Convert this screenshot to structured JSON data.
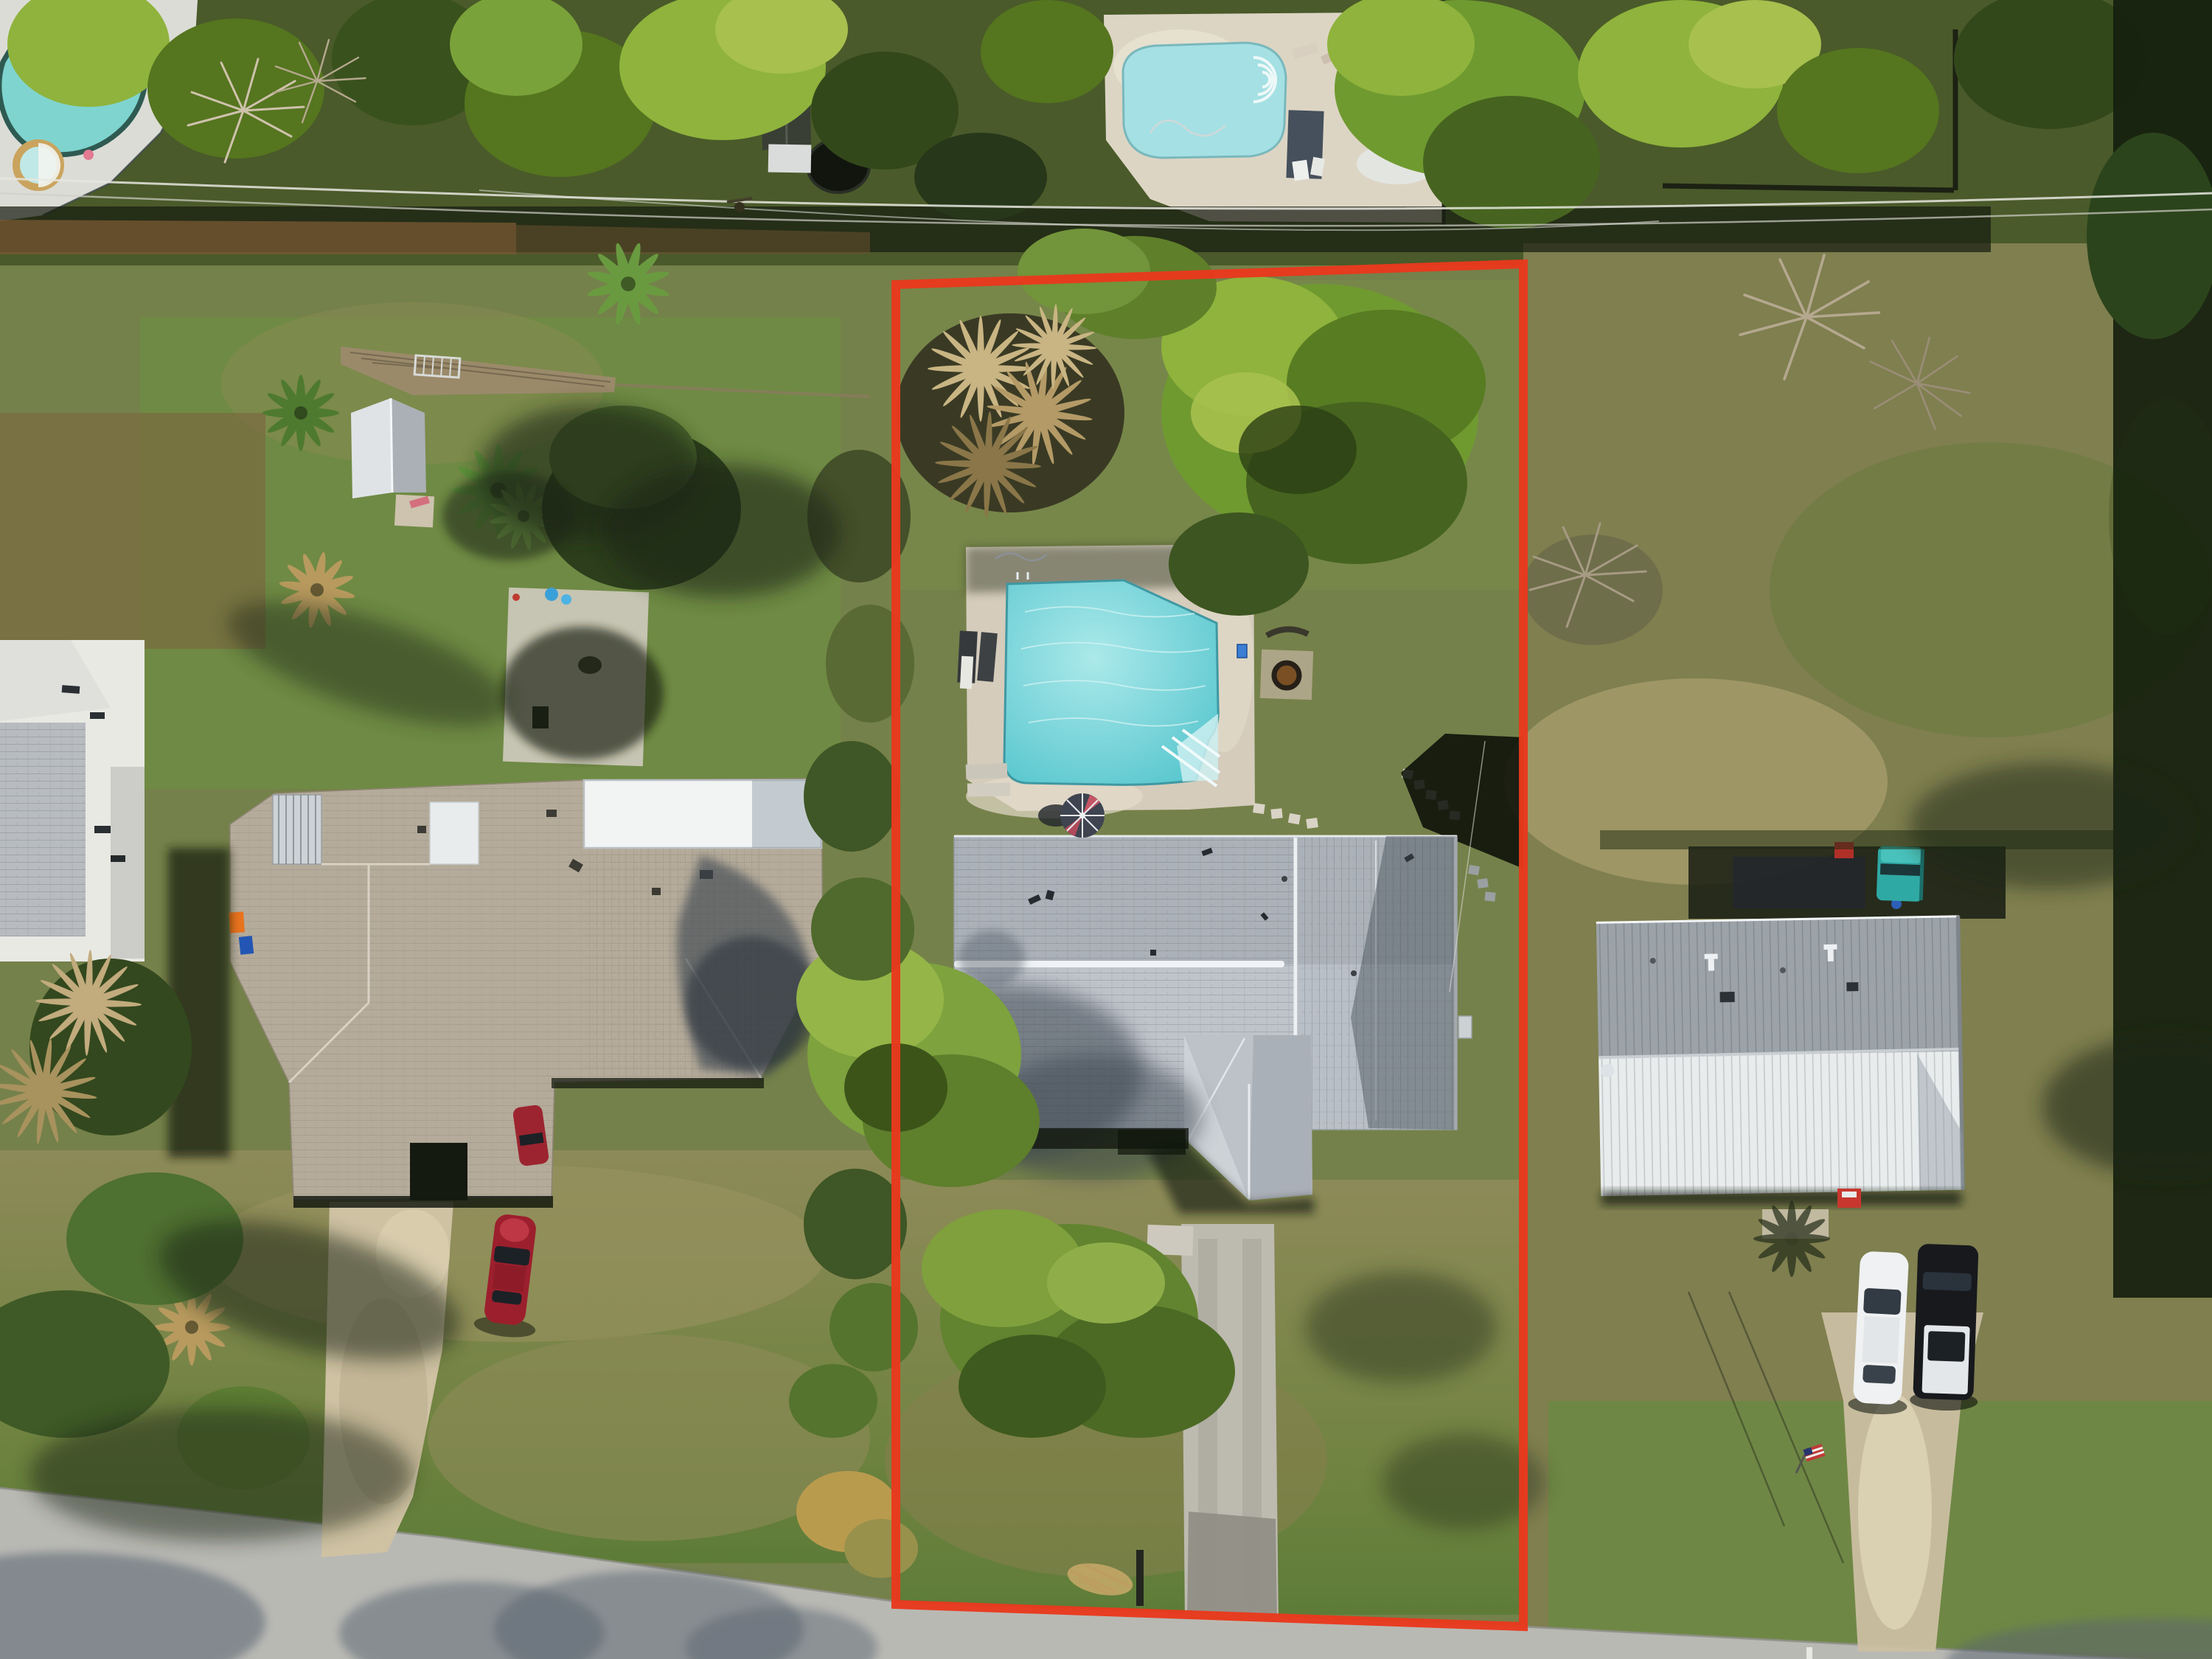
{
  "meta": {
    "title": "Aerial drone photograph of a residential lot outlined in red",
    "type": "aerial-photograph",
    "visible_text": "none"
  },
  "colors": {
    "ground_base": "#75814a",
    "lawn_green": "#71853f",
    "lawn_dry": "#9a9361",
    "tree_bright": "#8fb33c",
    "tree_dark": "#27371a",
    "boundary_red": "#e8391d",
    "street_concrete": "#b9b9b4",
    "pool_deck": "#d5ccbc",
    "subject_pool_center": "#abe9ea",
    "subject_pool_edge": "#57c6ce",
    "nw_pool_water": "#7fd4cf",
    "north_pool_water": "#a4e0e4",
    "subject_roof": "#b9bfc6",
    "subject_roof_ridge": "#f0f3f5",
    "left_house_roof": "#b5ab9a",
    "left_lanai_roof": "#f2f4f4",
    "mobile_home_roof_shaded": "#9ba2a8",
    "mobile_home_roof_sunlit": "#e9eced",
    "driveway_left_tan": "#cfc2a3",
    "driveway_subject": "#bdbab0",
    "red_car": "#9c1f2d",
    "teal_truck": "#2fa9a4",
    "white_car": "#eff1f2",
    "black_suv": "#17191d",
    "orange_bin": "#e8731f",
    "blue_bin": "#2356b4"
  },
  "scene": {
    "objects": [
      "property-boundary-outline",
      "subject-house",
      "subject-pool",
      "subject-pool-deck",
      "subject-driveway",
      "backyard-fire-pit",
      "patio-umbrella",
      "left-neighbor-house",
      "left-driveway",
      "red-car",
      "far-left-white-house",
      "garden-shed",
      "northwest-pool",
      "north-pool",
      "wood-fence-row",
      "mobile-home",
      "teal-truck",
      "white-car",
      "black-suv",
      "gravel-path",
      "street",
      "power-lines",
      "american-flag",
      "mailbox-post",
      "stepping-stones",
      "recycling-bins",
      "palm-trees",
      "tree-canopies",
      "shadows",
      "lounge-chairs"
    ]
  }
}
